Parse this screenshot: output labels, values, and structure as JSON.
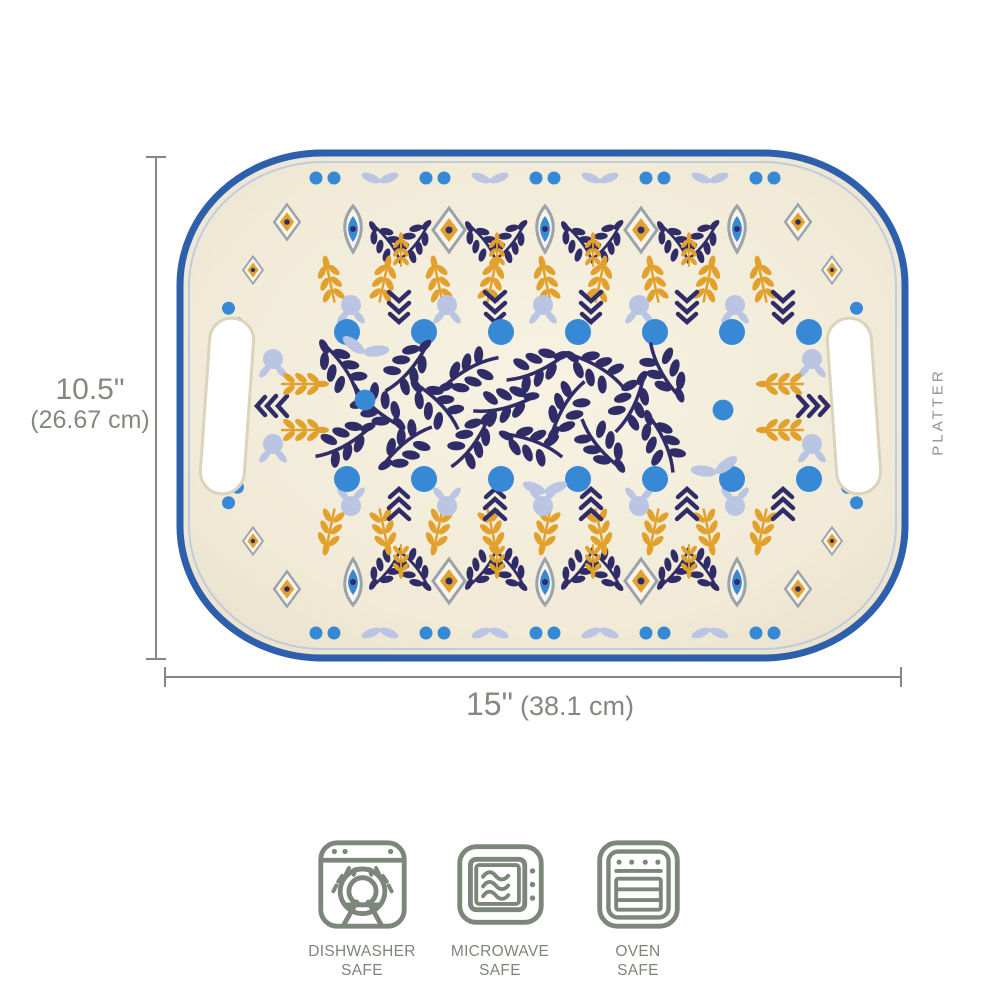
{
  "product_label": "PLATTER",
  "dimensions": {
    "height_in": "10.5\"",
    "height_cm": "(26.67 cm)",
    "width_in": "15\"",
    "width_cm": "(38.1 cm)"
  },
  "badges": [
    {
      "icon": "dishwasher-icon",
      "line1": "DISHWASHER",
      "line2": "SAFE"
    },
    {
      "icon": "microwave-icon",
      "line1": "MICROWAVE",
      "line2": "SAFE"
    },
    {
      "icon": "oven-icon",
      "line1": "OVEN",
      "line2": "SAFE"
    }
  ],
  "colors": {
    "rim_blue": "#2d5fad",
    "cream": "#f2ecd9",
    "navy": "#302c68",
    "bright_blue": "#3789d6",
    "light_blue": "#b9c5e2",
    "gold": "#e2a12d",
    "gray": "#9aa3ad",
    "annotation_gray": "#82897f",
    "icon_green": "#7c867a"
  }
}
